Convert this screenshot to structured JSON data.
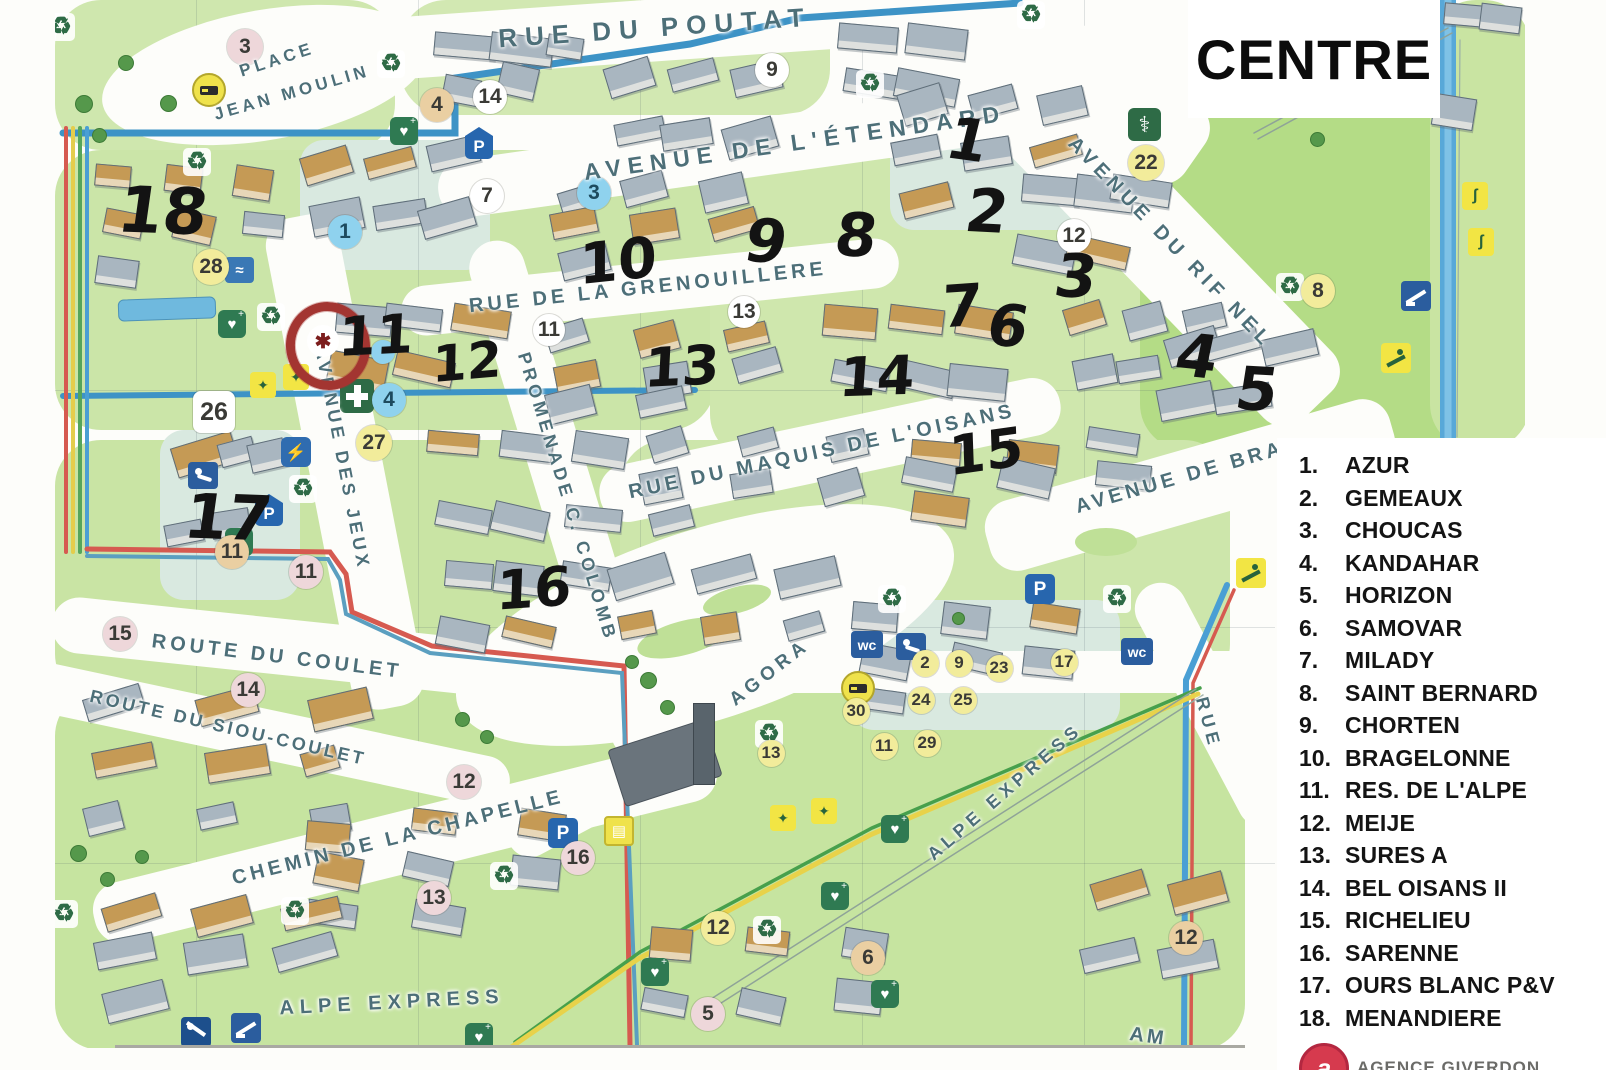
{
  "title": "CENTRE",
  "legend": {
    "items": [
      {
        "num": "1.",
        "label": "AZUR"
      },
      {
        "num": "2.",
        "label": "GEMEAUX"
      },
      {
        "num": "3.",
        "label": "CHOUCAS"
      },
      {
        "num": "4.",
        "label": "KANDAHAR"
      },
      {
        "num": "5.",
        "label": "HORIZON"
      },
      {
        "num": "6.",
        "label": "SAMOVAR"
      },
      {
        "num": "7.",
        "label": "MILADY"
      },
      {
        "num": "8.",
        "label": "SAINT BERNARD"
      },
      {
        "num": "9.",
        "label": "CHORTEN"
      },
      {
        "num": "10.",
        "label": "BRAGELONNE"
      },
      {
        "num": "11.",
        "label": "RES. DE L'ALPE"
      },
      {
        "num": "12.",
        "label": "MEIJE"
      },
      {
        "num": "13.",
        "label": "SURES A"
      },
      {
        "num": "14.",
        "label": "BEL OISANS II"
      },
      {
        "num": "15.",
        "label": "RICHELIEU"
      },
      {
        "num": "16.",
        "label": "SARENNE"
      },
      {
        "num": "17.",
        "label": "OURS BLANC P&V"
      },
      {
        "num": "18.",
        "label": "MENANDIERE"
      }
    ]
  },
  "branding": {
    "logo_letter": "a",
    "agency_text": "AGENCE GIVERDON"
  },
  "map": {
    "streets": [
      {
        "label": "RUE DU POUTAT",
        "x": 655,
        "y": 28,
        "rot": -4,
        "size": 26,
        "ls": 8
      },
      {
        "label": "AVENUE DE L'ÉTENDARD",
        "x": 795,
        "y": 143,
        "rot": -8,
        "size": 23,
        "ls": 7
      },
      {
        "label": "PLACE",
        "x": 277,
        "y": 60,
        "rot": -18,
        "size": 17,
        "ls": 4
      },
      {
        "label": "JEAN MOULIN",
        "x": 292,
        "y": 93,
        "rot": -16,
        "size": 17,
        "ls": 4
      },
      {
        "label": "RUE DE LA GRENOUILLERE",
        "x": 648,
        "y": 288,
        "rot": -6,
        "size": 20,
        "ls": 4
      },
      {
        "label": "RUE DU MAQUIS DE L'OISANS",
        "x": 822,
        "y": 452,
        "rot": -12,
        "size": 20,
        "ls": 4
      },
      {
        "label": "AVENUE DU RIF NEL",
        "x": 1170,
        "y": 243,
        "rot": 46,
        "size": 20,
        "ls": 5
      },
      {
        "label": "AVENUE DE BRA",
        "x": 1180,
        "y": 478,
        "rot": -16,
        "size": 20,
        "ls": 4
      },
      {
        "label": "PROMENADE C. COLOMB",
        "x": 567,
        "y": 497,
        "rot": 73,
        "size": 18,
        "ls": 4
      },
      {
        "label": "AVENUE DES JEUX",
        "x": 342,
        "y": 458,
        "rot": 79,
        "size": 18,
        "ls": 4
      },
      {
        "label": "ROUTE DU COULET",
        "x": 277,
        "y": 657,
        "rot": 7,
        "size": 20,
        "ls": 4
      },
      {
        "label": "ROUTE DU SIOU-COULET",
        "x": 228,
        "y": 728,
        "rot": 13,
        "size": 18,
        "ls": 3
      },
      {
        "label": "CHEMIN DE LA CHAPELLE",
        "x": 398,
        "y": 838,
        "rot": -14,
        "size": 20,
        "ls": 4
      },
      {
        "label": "ALPE EXPRESS",
        "x": 392,
        "y": 1003,
        "rot": -3,
        "size": 20,
        "ls": 6
      },
      {
        "label": "ALPE EXPRESS",
        "x": 1005,
        "y": 792,
        "rot": -41,
        "size": 18,
        "ls": 5
      },
      {
        "label": "AGORA",
        "x": 770,
        "y": 673,
        "rot": -38,
        "size": 19,
        "ls": 5
      },
      {
        "label": "RUE",
        "x": 1208,
        "y": 723,
        "rot": 75,
        "size": 18,
        "ls": 5
      },
      {
        "label": "AM",
        "x": 1148,
        "y": 1037,
        "rot": 8,
        "size": 20,
        "ls": 3
      }
    ],
    "handwritten": [
      {
        "label": "18",
        "x": 163,
        "y": 212,
        "size": 64,
        "rot": 2
      },
      {
        "label": "1",
        "x": 968,
        "y": 140,
        "size": 58,
        "rot": 8
      },
      {
        "label": "2",
        "x": 987,
        "y": 212,
        "size": 60,
        "rot": 3
      },
      {
        "label": "10",
        "x": 618,
        "y": 262,
        "size": 56,
        "rot": -6
      },
      {
        "label": "9",
        "x": 766,
        "y": 242,
        "size": 60,
        "rot": 4
      },
      {
        "label": "8",
        "x": 856,
        "y": 236,
        "size": 60,
        "rot": 2
      },
      {
        "label": "3",
        "x": 1076,
        "y": 277,
        "size": 60,
        "rot": 3
      },
      {
        "label": "7",
        "x": 962,
        "y": 306,
        "size": 58,
        "rot": -4
      },
      {
        "label": "6",
        "x": 1008,
        "y": 326,
        "size": 58,
        "rot": 5
      },
      {
        "label": "4",
        "x": 1197,
        "y": 357,
        "size": 60,
        "rot": 6
      },
      {
        "label": "5",
        "x": 1257,
        "y": 390,
        "size": 60,
        "rot": 3
      },
      {
        "label": "11",
        "x": 376,
        "y": 336,
        "size": 54,
        "rot": -3
      },
      {
        "label": "12",
        "x": 467,
        "y": 362,
        "size": 50,
        "rot": -5
      },
      {
        "label": "13",
        "x": 682,
        "y": 367,
        "size": 54,
        "rot": -3
      },
      {
        "label": "14",
        "x": 877,
        "y": 377,
        "size": 54,
        "rot": -2
      },
      {
        "label": "15",
        "x": 986,
        "y": 452,
        "size": 54,
        "rot": -8
      },
      {
        "label": "16",
        "x": 534,
        "y": 589,
        "size": 54,
        "rot": -4
      },
      {
        "label": "17",
        "x": 228,
        "y": 518,
        "size": 62,
        "rot": 2
      }
    ],
    "markers": [
      {
        "label": "3",
        "x": 245,
        "y": 47,
        "color": "pink",
        "d": 36
      },
      {
        "label": "4",
        "x": 437,
        "y": 105,
        "color": "tan",
        "d": 34
      },
      {
        "label": "14",
        "x": 490,
        "y": 97,
        "color": "white",
        "d": 34
      },
      {
        "label": "9",
        "x": 772,
        "y": 70,
        "color": "white",
        "d": 34
      },
      {
        "label": "7",
        "x": 487,
        "y": 196,
        "color": "white",
        "d": 34
      },
      {
        "label": "3",
        "x": 594,
        "y": 193,
        "color": "blue",
        "d": 34
      },
      {
        "label": "1",
        "x": 345,
        "y": 232,
        "color": "blue",
        "d": 34
      },
      {
        "label": "28",
        "x": 211,
        "y": 267,
        "color": "yellow",
        "d": 36
      },
      {
        "label": "12",
        "x": 1074,
        "y": 236,
        "color": "white",
        "d": 34
      },
      {
        "label": "22",
        "x": 1146,
        "y": 163,
        "color": "yellow",
        "d": 36
      },
      {
        "label": "8",
        "x": 1318,
        "y": 291,
        "color": "yellow",
        "d": 34
      },
      {
        "label": "11",
        "x": 549,
        "y": 330,
        "color": "white",
        "d": 32
      },
      {
        "label": "13",
        "x": 744,
        "y": 312,
        "color": "white",
        "d": 32
      },
      {
        "label": "",
        "x": 383,
        "y": 352,
        "color": "blue",
        "d": 24
      },
      {
        "label": "4",
        "x": 389,
        "y": 400,
        "color": "blue",
        "d": 34
      },
      {
        "label": "27",
        "x": 374,
        "y": 443,
        "color": "yellow",
        "d": 36
      },
      {
        "label": "26",
        "x": 214,
        "y": 412,
        "color": "white",
        "d": 42,
        "square": true
      },
      {
        "label": "11",
        "x": 232,
        "y": 552,
        "color": "tan",
        "d": 34
      },
      {
        "label": "11",
        "x": 306,
        "y": 572,
        "color": "pink",
        "d": 34
      },
      {
        "label": "15",
        "x": 120,
        "y": 634,
        "color": "pink",
        "d": 34
      },
      {
        "label": "14",
        "x": 248,
        "y": 690,
        "color": "pink",
        "d": 34
      },
      {
        "label": "12",
        "x": 464,
        "y": 782,
        "color": "pink",
        "d": 34
      },
      {
        "label": "16",
        "x": 578,
        "y": 858,
        "color": "pink",
        "d": 34
      },
      {
        "label": "13",
        "x": 434,
        "y": 898,
        "color": "pink",
        "d": 34
      },
      {
        "label": "12",
        "x": 718,
        "y": 928,
        "color": "yellow",
        "d": 34
      },
      {
        "label": "6",
        "x": 868,
        "y": 958,
        "color": "tan",
        "d": 34
      },
      {
        "label": "5",
        "x": 708,
        "y": 1014,
        "color": "pink",
        "d": 34
      },
      {
        "label": "12",
        "x": 1186,
        "y": 938,
        "color": "tan",
        "d": 34
      }
    ],
    "agora_markers": [
      {
        "label": "2",
        "x": 925,
        "y": 663
      },
      {
        "label": "9",
        "x": 959,
        "y": 663
      },
      {
        "label": "23",
        "x": 999,
        "y": 668
      },
      {
        "label": "17",
        "x": 1064,
        "y": 662
      },
      {
        "label": "24",
        "x": 921,
        "y": 700
      },
      {
        "label": "25",
        "x": 963,
        "y": 700
      },
      {
        "label": "30",
        "x": 856,
        "y": 711
      },
      {
        "label": "11",
        "x": 884,
        "y": 746
      },
      {
        "label": "29",
        "x": 927,
        "y": 743
      },
      {
        "label": "13",
        "x": 771,
        "y": 753
      }
    ],
    "icons": [
      {
        "type": "recycle-icon",
        "x": 62,
        "y": 28
      },
      {
        "type": "recycle-icon",
        "x": 392,
        "y": 65
      },
      {
        "type": "recycle-icon",
        "x": 198,
        "y": 163
      },
      {
        "type": "recycle-icon",
        "x": 871,
        "y": 85
      },
      {
        "type": "recycle-icon",
        "x": 1032,
        "y": 16
      },
      {
        "type": "recycle-icon",
        "x": 272,
        "y": 318
      },
      {
        "type": "recycle-icon",
        "x": 304,
        "y": 490
      },
      {
        "type": "recycle-icon",
        "x": 893,
        "y": 600
      },
      {
        "type": "recycle-icon",
        "x": 1118,
        "y": 600
      },
      {
        "type": "recycle-icon",
        "x": 1291,
        "y": 288
      },
      {
        "type": "recycle-icon",
        "x": 770,
        "y": 735
      },
      {
        "type": "recycle-icon",
        "x": 505,
        "y": 877
      },
      {
        "type": "recycle-icon",
        "x": 296,
        "y": 912
      },
      {
        "type": "recycle-icon",
        "x": 65,
        "y": 915
      },
      {
        "type": "recycle-icon",
        "x": 768,
        "y": 931
      },
      {
        "type": "parking-pin-icon",
        "x": 480,
        "y": 142
      },
      {
        "type": "parking-pin-icon",
        "x": 270,
        "y": 509
      },
      {
        "type": "parking-icon",
        "x": 1040,
        "y": 589
      },
      {
        "type": "parking-icon",
        "x": 563,
        "y": 833
      },
      {
        "type": "wc-icon",
        "x": 866,
        "y": 646
      },
      {
        "type": "wc-icon",
        "x": 1136,
        "y": 653
      },
      {
        "type": "baby-change-icon",
        "x": 911,
        "y": 648
      },
      {
        "type": "baby-change-icon",
        "x": 203,
        "y": 477
      },
      {
        "type": "ev-plug-icon",
        "x": 296,
        "y": 452
      },
      {
        "type": "pharmacy-icon",
        "x": 355,
        "y": 394
      },
      {
        "type": "doctor-icon",
        "x": 1143,
        "y": 123
      },
      {
        "type": "defibrillator-icon",
        "x": 233,
        "y": 325
      },
      {
        "type": "defibrillator-icon",
        "x": 405,
        "y": 104
      },
      {
        "type": "defibrillator-icon",
        "x": 240,
        "y": 487
      },
      {
        "type": "defibrillator-icon",
        "x": 656,
        "y": 889
      },
      {
        "type": "defibrillator-icon",
        "x": 480,
        "y": 926
      },
      {
        "type": "defibrillator-icon",
        "x": 896,
        "y": 690
      },
      {
        "type": "defibrillator-icon",
        "x": 836,
        "y": 729
      },
      {
        "type": "defibrillator-icon",
        "x": 886,
        "y": 799
      },
      {
        "type": "bus-icon",
        "x": 207,
        "y": 88
      },
      {
        "type": "bus-icon",
        "x": 856,
        "y": 686
      },
      {
        "type": "basket-icon",
        "x": 619,
        "y": 831
      },
      {
        "type": "playground-icon",
        "x": 265,
        "y": 387
      },
      {
        "type": "playground-icon",
        "x": 298,
        "y": 379
      },
      {
        "type": "playground-icon",
        "x": 785,
        "y": 820
      },
      {
        "type": "playground-icon",
        "x": 826,
        "y": 813
      },
      {
        "type": "skier-icon",
        "x": 1396,
        "y": 358
      },
      {
        "type": "skier-icon",
        "x": 1251,
        "y": 573
      },
      {
        "type": "ski-jump-icon",
        "x": 1416,
        "y": 296
      },
      {
        "type": "ski-jump-icon",
        "x": 246,
        "y": 1028
      },
      {
        "type": "sledge-icon",
        "x": 196,
        "y": 1032
      },
      {
        "type": "luge-icon",
        "x": 1477,
        "y": 197
      },
      {
        "type": "luge-icon",
        "x": 1483,
        "y": 243
      },
      {
        "type": "swimming-icon",
        "x": 240,
        "y": 272
      }
    ],
    "highlight": {
      "x": 323,
      "y": 341,
      "glyph": "✱"
    }
  }
}
